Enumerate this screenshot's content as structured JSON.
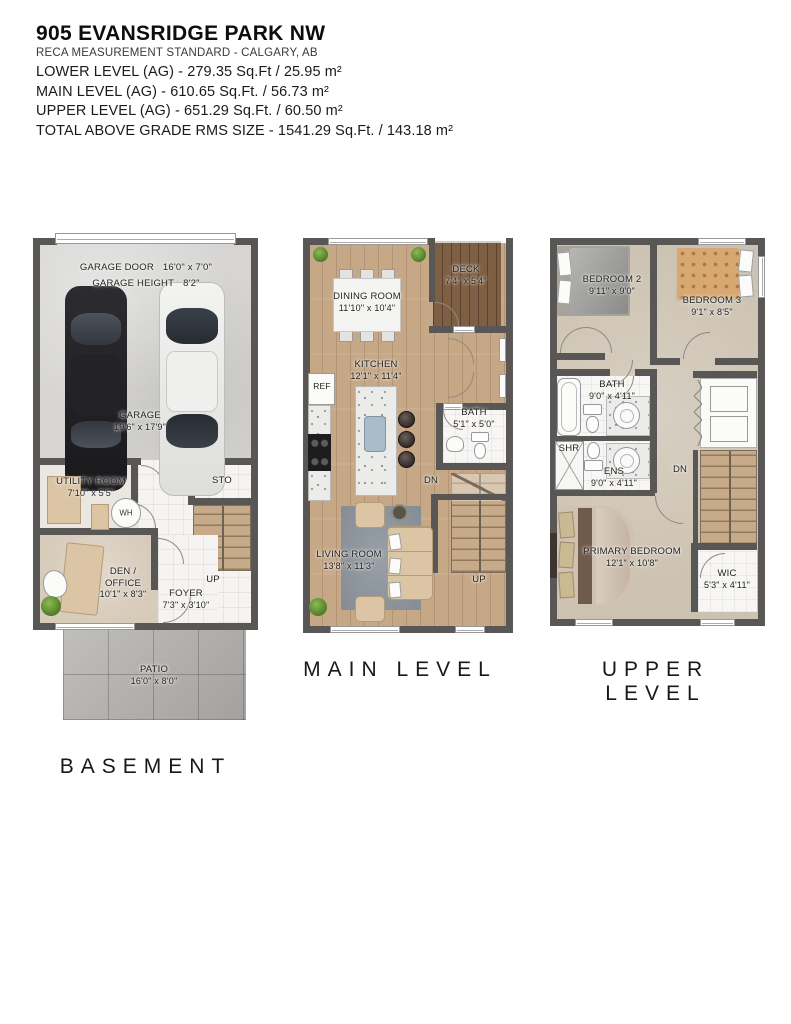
{
  "header": {
    "title": "905 EVANSRIDGE PARK NW",
    "standard": "RECA MEASUREMENT STANDARD - CALGARY, AB",
    "areas": [
      "LOWER LEVEL (AG) - 279.35 Sq.Ft / 25.95 m²",
      "MAIN LEVEL (AG) - 610.65 Sq.Ft. / 56.73 m²",
      "UPPER LEVEL (AG) - 651.29 Sq.Ft. / 60.50 m²",
      "TOTAL ABOVE GRADE RMS SIZE - 1541.29 Sq.Ft. / 143.18 m²"
    ]
  },
  "basement": {
    "label": "BASEMENT",
    "garage_door": {
      "name": "GARAGE DOOR",
      "dims": "16'0\" x 7'0\""
    },
    "garage_height": {
      "name": "GARAGE HEIGHT",
      "dims": "8'2\""
    },
    "garage": {
      "name": "GARAGE",
      "dims": "19'6\" x 17'9\""
    },
    "utility": {
      "name": "UTILITY ROOM",
      "dims": "7'10\" x 5'5\""
    },
    "wh": "WH",
    "sto": "STO",
    "den": {
      "name": "DEN / OFFICE",
      "dims": "10'1\" x 8'3\""
    },
    "foyer": {
      "name": "FOYER",
      "dims": "7'3\" x 3'10\""
    },
    "up": "UP",
    "patio": {
      "name": "PATIO",
      "dims": "16'0\" x 8'0\""
    }
  },
  "main": {
    "label": "MAIN LEVEL",
    "deck": {
      "name": "DECK",
      "dims": "7'4\" x 5'4\""
    },
    "dining": {
      "name": "DINING ROOM",
      "dims": "11'10\" x 10'4\""
    },
    "kitchen": {
      "name": "KITCHEN",
      "dims": "12'1\" x 11'4\""
    },
    "ref": "REF",
    "bath": {
      "name": "BATH",
      "dims": "5'1\" x 5'0\""
    },
    "dn": "DN",
    "living": {
      "name": "LIVING ROOM",
      "dims": "13'8\" x 11'3\""
    },
    "up": "UP"
  },
  "upper": {
    "label": "UPPER LEVEL",
    "bedroom2": {
      "name": "BEDROOM 2",
      "dims": "9'11\" x 9'0\""
    },
    "bedroom3": {
      "name": "BEDROOM 3",
      "dims": "9'1\" x 8'5\""
    },
    "bath": {
      "name": "BATH",
      "dims": "9'0\" x 4'11\""
    },
    "shr": "SHR",
    "ens": {
      "name": "ENS",
      "dims": "9'0\" x 4'11\""
    },
    "dn": "DN",
    "primary": {
      "name": "PRIMARY BEDROOM",
      "dims": "12'1\" x 10'8\""
    },
    "wic": {
      "name": "WIC",
      "dims": "5'3\" x 4'11\""
    }
  },
  "colors": {
    "wall": "#585755",
    "wood_floor": "#c6a887",
    "deck_wood": "#7e5f44",
    "carpet": "#ccc2b1",
    "concrete": "#d6d5d3",
    "patio": "#b6b4b0",
    "rug": "#8d949c"
  }
}
